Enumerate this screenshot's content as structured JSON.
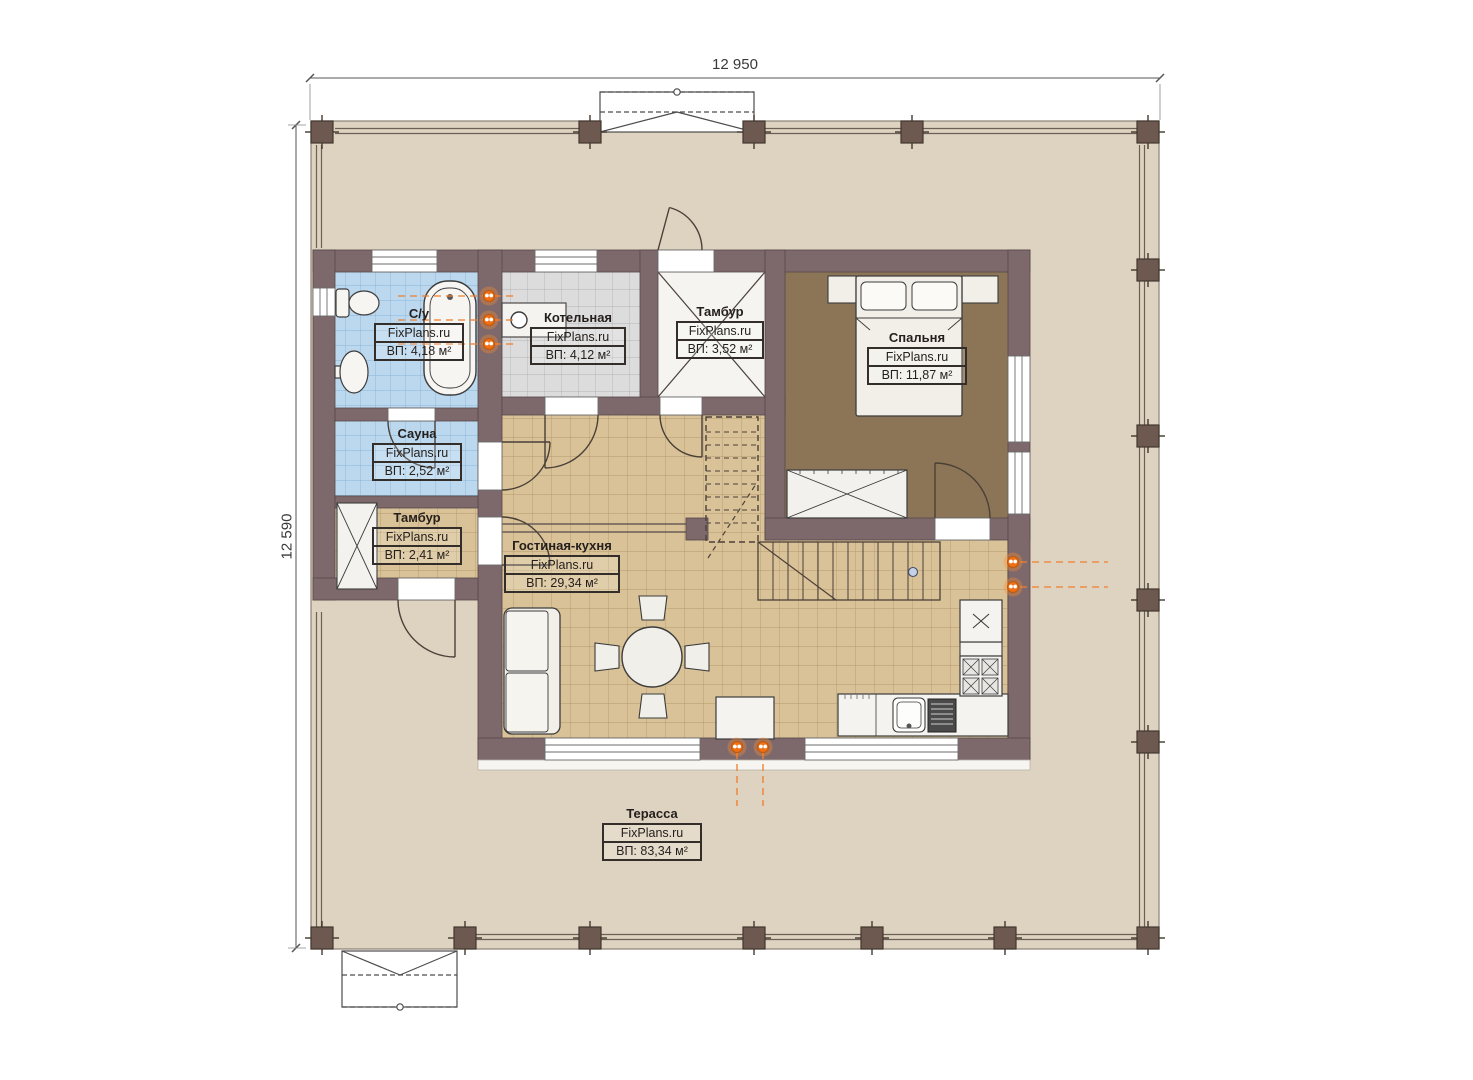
{
  "plan": {
    "dimensions": {
      "width_label": "12 950",
      "height_label": "12 590"
    },
    "watermark": "FixPlans.ru",
    "rooms": [
      {
        "name": "С/у",
        "brand": "FixPlans.ru",
        "area": "ВП: 4,18 м²"
      },
      {
        "name": "Котельная",
        "brand": "FixPlans.ru",
        "area": "ВП: 4,12 м²"
      },
      {
        "name": "Тамбур",
        "brand": "FixPlans.ru",
        "area": "ВП: 3,52 м²"
      },
      {
        "name": "Спальня",
        "brand": "FixPlans.ru",
        "area": "ВП: 11,87 м²"
      },
      {
        "name": "Сауна",
        "brand": "FixPlans.ru",
        "area": "ВП: 2,52 м²"
      },
      {
        "name": "Тамбур",
        "brand": "FixPlans.ru",
        "area": "ВП: 2,41 м²"
      },
      {
        "name": "Гостиная-кухня",
        "brand": "FixPlans.ru",
        "area": "ВП: 29,34 м²"
      },
      {
        "name": "Терасса",
        "brand": "FixPlans.ru",
        "area": "ВП: 83,34 м²"
      }
    ],
    "colors": {
      "wall": "#7d696b",
      "terrace_floor": "#ded3c0",
      "tile_floor": "#d9c297",
      "wet_floor": "#bcd8ee",
      "boiler_floor": "#dcdcdc",
      "bedroom_floor": "#8c7557",
      "plumbing_accent": "#ee6f15"
    }
  }
}
